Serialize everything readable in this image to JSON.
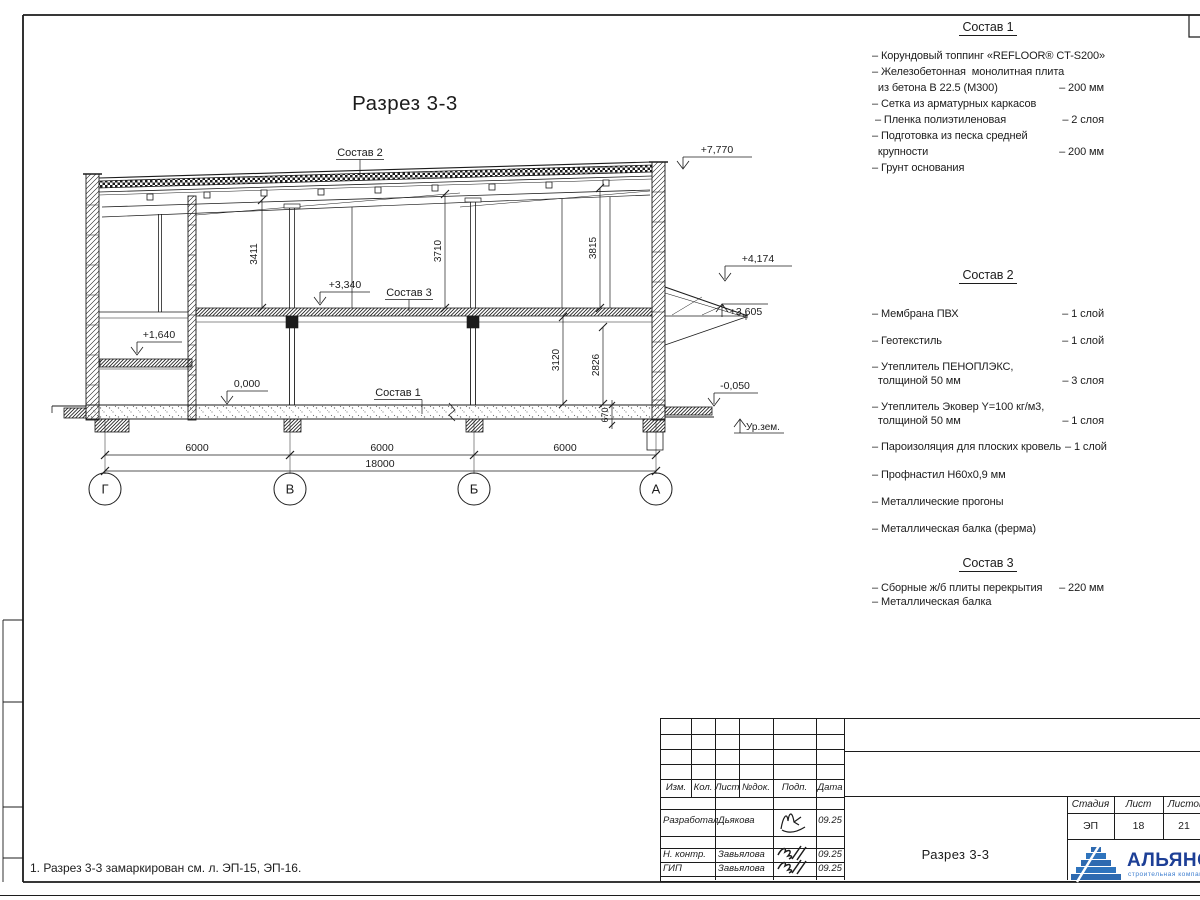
{
  "page": {
    "note": "1. Разрез 3-3 замаркирован см. л. ЭП-15, ЭП-16."
  },
  "drawing": {
    "title": "Разрез 3-3",
    "axis": [
      "Г",
      "В",
      "Б",
      "А"
    ],
    "levels": {
      "roof": "+7,770",
      "canopy_top": "+4,174",
      "canopy_bottom": "+3,605",
      "mezzanine": "+3,340",
      "left_slab": "+1,640",
      "zero": "0,000",
      "entry": "-0,050",
      "ground": "Ур.зем."
    },
    "dims": {
      "bay1": "6000",
      "bay2": "6000",
      "bay3": "6000",
      "total": "18000",
      "h1": "3411",
      "h2": "3710",
      "h3": "3815",
      "h4": "3120",
      "h5": "2826",
      "h6": "670"
    },
    "callouts": {
      "c1": "Состав 1",
      "c2": "Состав 2",
      "c3": "Состав 3"
    }
  },
  "specs": {
    "s1": {
      "title": "Состав 1",
      "lines": [
        {
          "t": "– Корундовый топпинг «REFLOOR® CT-S200»",
          "v": ""
        },
        {
          "t": "– Железобетонная  монолитная плита",
          "v": ""
        },
        {
          "t": "  из бетона В 22.5 (М300)",
          "v": "– 200 мм"
        },
        {
          "t": "– Сетка из арматурных каркасов",
          "v": ""
        },
        {
          "t": " – Пленка полиэтиленовая",
          "v": "– 2 слоя"
        },
        {
          "t": "– Подготовка из песка средней",
          "v": ""
        },
        {
          "t": "  крупности",
          "v": "– 200 мм"
        },
        {
          "t": "– Грунт основания",
          "v": ""
        }
      ]
    },
    "s2": {
      "title": "Состав 2",
      "lines": [
        {
          "t": "– Мембрана ПВХ",
          "v": "– 1 слой"
        },
        {
          "t": "– Геотекстиль",
          "v": "– 1 слой"
        },
        {
          "t": "– Утеплитель ПЕНОПЛЭКС,",
          "v": ""
        },
        {
          "t": "  толщиной 50 мм",
          "v": "– 3 слоя"
        },
        {
          "t": "– Утеплитель Эковер Y=100 кг/м3,",
          "v": ""
        },
        {
          "t": "  толщиной 50 мм",
          "v": "– 1 слоя"
        },
        {
          "t": "– Пароизоляция для плоских кровель",
          "v": "– 1 слой"
        },
        {
          "t": "– Профнастил Н60х0,9 мм",
          "v": ""
        },
        {
          "t": "– Металлические прогоны",
          "v": ""
        },
        {
          "t": "– Металлическая балка (ферма)",
          "v": ""
        }
      ]
    },
    "s3": {
      "title": "Состав 3",
      "lines": [
        {
          "t": "– Сборные ж/б плиты перекрытия",
          "v": "– 220 мм"
        },
        {
          "t": "– Металлическая балка",
          "v": ""
        }
      ]
    }
  },
  "stamp": {
    "cols": [
      "Изм.",
      "Кол.",
      "Лист",
      "№док.",
      "Подп.",
      "Дата"
    ],
    "rows": [
      {
        "role": "Разработал",
        "name": "Дьякова",
        "date": "09.25"
      },
      {
        "role": "Н. контр.",
        "name": "Завьялова",
        "date": "09.25"
      },
      {
        "role": "ГИП",
        "name": "Завьялова",
        "date": "09.25"
      }
    ],
    "doc_title": "Разрез 3-3",
    "stage_cols": [
      "Стадия",
      "Лист",
      "Листов"
    ],
    "stage": "ЭП",
    "sheet": "18",
    "sheets": "21",
    "logo": {
      "name": "АЛЬЯНС",
      "tagline": "строительная компания"
    }
  },
  "colors": {
    "ink": "#1c1c1c",
    "logo_blue": "#2e6ab0",
    "logo_navy": "#1d3f96",
    "logo_light": "#3f7fd0"
  }
}
